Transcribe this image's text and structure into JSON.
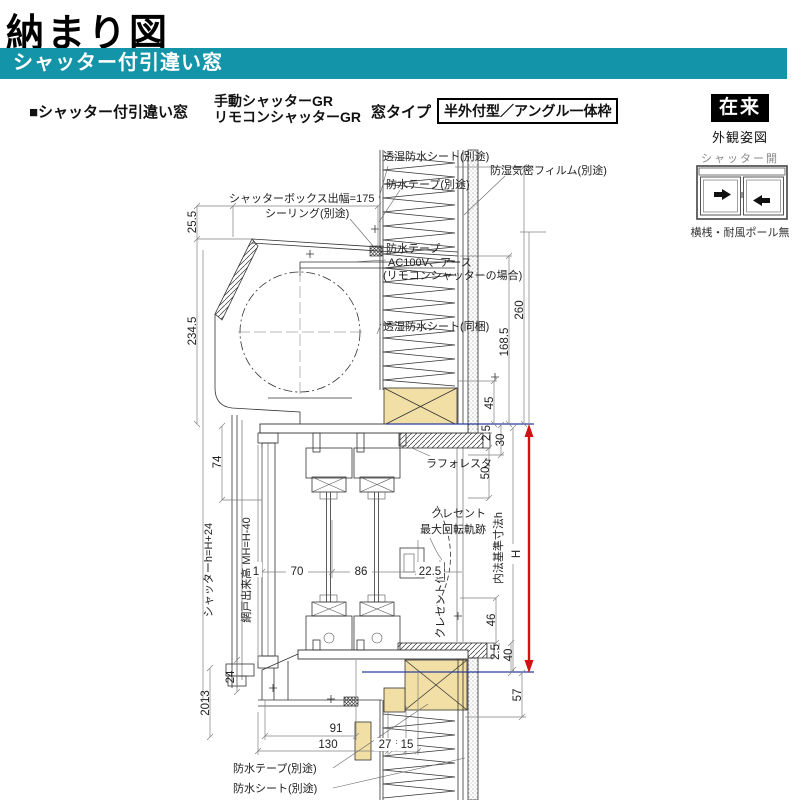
{
  "page": {
    "title": "納まり図"
  },
  "header": {
    "bar_title": "シャッター付引違い窓"
  },
  "section": {
    "heading": "■シャッター付引違い窓",
    "shutter_types": [
      "手動シャッターGR",
      "リモコンシャッターGR"
    ],
    "window_type_label": "窓タイプ",
    "frame_type": "半外付型／アングル一体枠"
  },
  "side_panel": {
    "construction": "在来",
    "view_label": "外観姿図",
    "shutter_state": "シャッター開",
    "bottom_note": "横桟・耐風ポール無"
  },
  "drawing": {
    "annotations": {
      "sheet_top": "透湿防水シート(別途)",
      "film": "防湿気密フィルム(別途)",
      "tape_top": "防水テープ(別途)",
      "box_depth": "シャッターボックス出幅=175",
      "sealing": "シーリング(別途)",
      "tape_mid": "防水テープ",
      "power": "AC100V、アース",
      "power2": "(リモコンシャッターの場合)",
      "sheet_mid": "透湿防水シート(同梱)",
      "laforesta": "ラフォレスタ",
      "crescent1": "クレセント",
      "crescent2": "最大回転軌跡",
      "crescent_pos": "クレセント位置",
      "screen_height": "網戸出来高 MH=H-40",
      "shutter_height": "シャッターh=H+24",
      "inner_std": "内法基準寸法h",
      "h_label": "H",
      "tape_bottom": "防水テープ(別途)",
      "sheet_bottom": "防水シート(別途)"
    },
    "dims": {
      "d25_5": "25.5",
      "d234_5": "234.5",
      "d74": "74",
      "d2013": "2013",
      "d24": "24",
      "d1": "1",
      "d70": "70",
      "d86": "86",
      "d22_5": "22.5",
      "d260": "260",
      "d168_5": "168.5",
      "d45": "45",
      "d2_5a": "2.5",
      "d30": "30",
      "d50": "50",
      "d46": "46",
      "d2_5b": "2.5",
      "d40": "40",
      "d57": "57",
      "d91": "91",
      "d130": "130",
      "d27": "27",
      "d15": "15"
    },
    "colors": {
      "teal": "#1494a8",
      "wood": "#f2dfa6",
      "red": "#d01212",
      "blue": "#2b3f9e"
    }
  }
}
